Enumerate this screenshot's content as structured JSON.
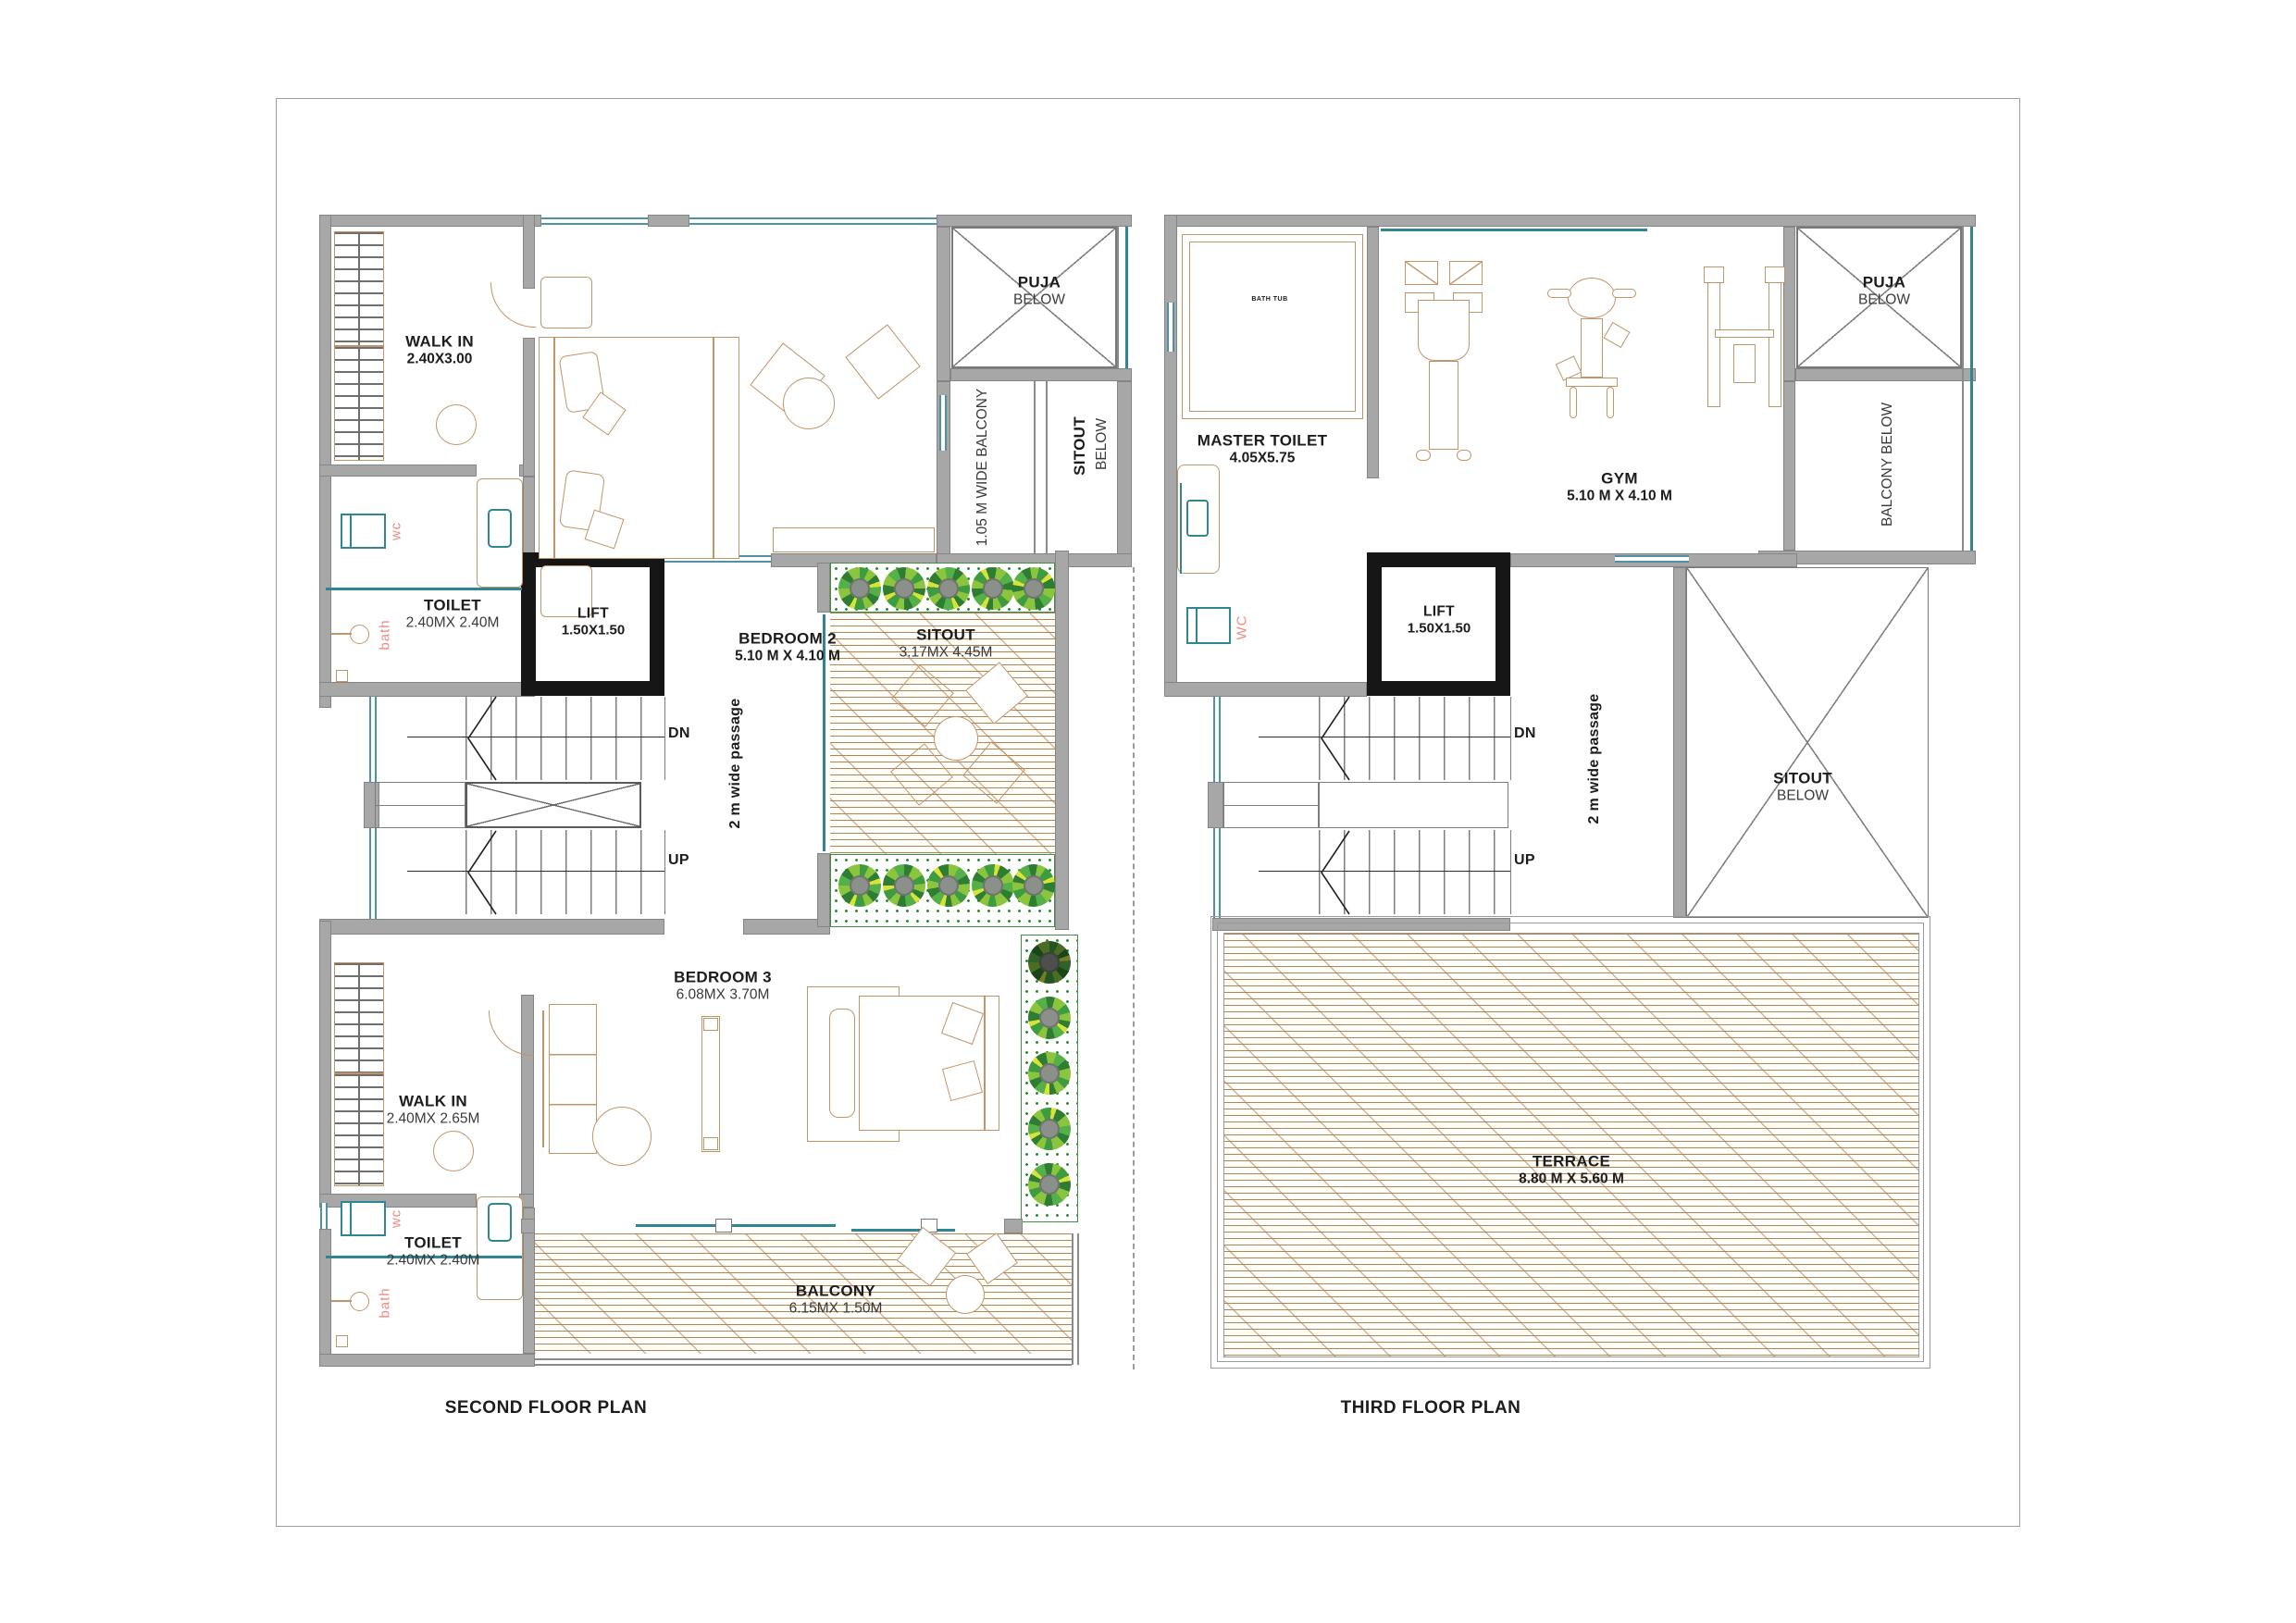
{
  "document": {
    "kind": "architectural floor plans",
    "sheet_background": "#ffffff"
  },
  "colors": {
    "wall_fill": "#a7a7a7",
    "lift_wall": "#161616",
    "furniture_outline": "#c0956a",
    "fixture_teal": "#2f8691",
    "window_teal": "#4f93a2",
    "accent_pink": "#ef8b85",
    "plank_line": "#a6784a",
    "plant_green": "#3f9b3f",
    "plant_yellow": "#d7e33b",
    "shrub_center": "#8b908b",
    "text": "#1c1c1c"
  },
  "second_floor": {
    "title": "SECOND FLOOR PLAN",
    "walk_in_top": {
      "name": "WALK IN",
      "dims": "2.40X3.00"
    },
    "toilet_top": {
      "name": "TOILET",
      "dims": "2.40MX 2.40M"
    },
    "bedroom2": {
      "name": "BEDROOM 2",
      "dims": "5.10 M X 4.10 M"
    },
    "puja": {
      "name": "PUJA",
      "below": "BELOW"
    },
    "wide_balcony": {
      "name": "1.05 M WIDE BALCONY"
    },
    "sitout_below": {
      "name": "SITOUT",
      "below": "BELOW"
    },
    "lift": {
      "name": "LIFT",
      "dims": "1.50X1.50"
    },
    "stairs": {
      "dn": "DN",
      "up": "UP"
    },
    "passage": {
      "name": "2 m wide passage"
    },
    "sitout": {
      "name": "SITOUT",
      "dims": "3.17MX 4.45M"
    },
    "bedroom3": {
      "name": "BEDROOM 3",
      "dims": "6.08MX 3.70M"
    },
    "walk_in_bottom": {
      "name": "WALK IN",
      "dims": "2.40MX 2.65M"
    },
    "toilet_bottom": {
      "name": "TOILET",
      "dims": "2.40MX 2.40M"
    },
    "balcony": {
      "name": "BALCONY",
      "dims": "6.15MX 1.50M"
    },
    "fixtures": {
      "wc_top": "wc",
      "bath_top": "bath",
      "wc_bottom": "wc",
      "bath_bottom": "bath"
    }
  },
  "third_floor": {
    "title": "THIRD FLOOR PLAN",
    "master_toilet": {
      "name": "MASTER TOILET",
      "dims": "4.05X5.75"
    },
    "bath_tub": {
      "name": "BATH TUB"
    },
    "gym": {
      "name": "GYM",
      "dims": "5.10 M X 4.10 M"
    },
    "puja": {
      "name": "PUJA",
      "below": "BELOW"
    },
    "balcony_below": {
      "name": "BALCONY BELOW"
    },
    "lift": {
      "name": "LIFT",
      "dims": "1.50X1.50"
    },
    "stairs": {
      "dn": "DN",
      "up": "UP"
    },
    "passage": {
      "name": "2 m wide passage"
    },
    "sitout_below": {
      "name": "SITOUT",
      "below": "BELOW"
    },
    "terrace": {
      "name": "TERRACE",
      "dims": "8.80 M X 5.60 M"
    },
    "fixtures": {
      "wc": "WC"
    }
  }
}
